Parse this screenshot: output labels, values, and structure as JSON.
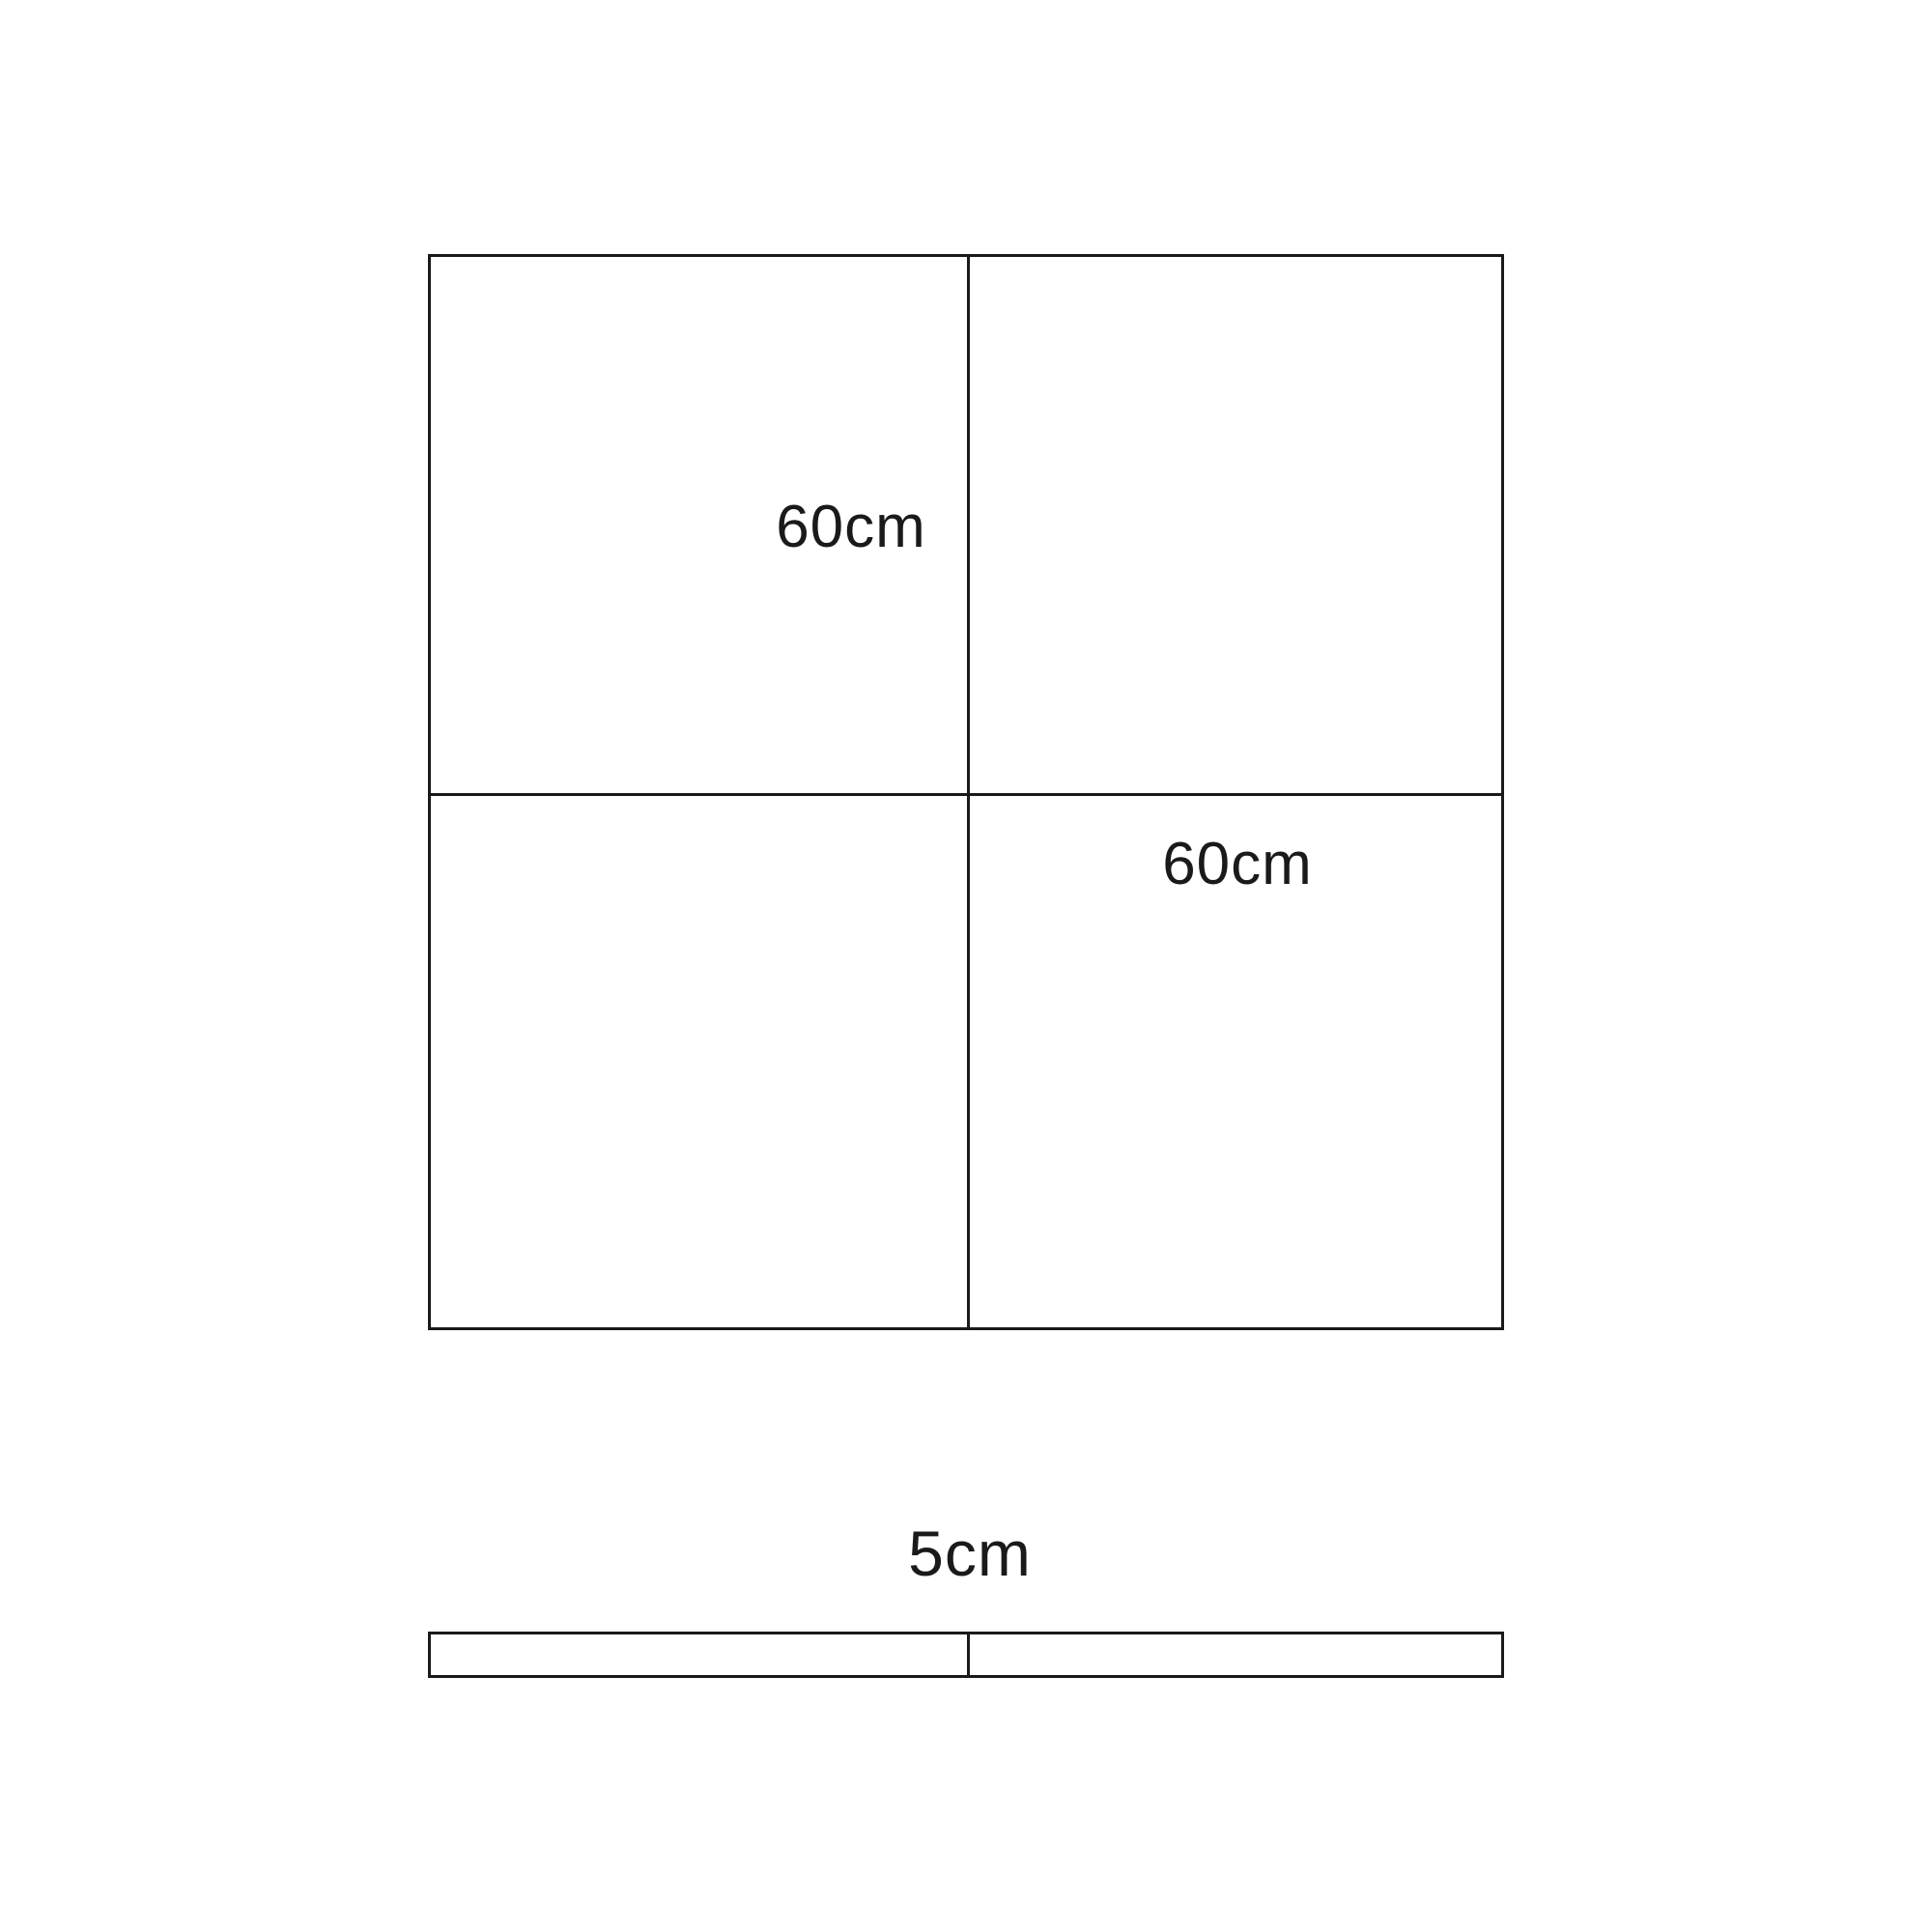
{
  "diagram": {
    "colors": {
      "background": "#ffffff",
      "line": "#1a1a1a",
      "text": "#1a1a1a"
    },
    "square": {
      "description": "large square divided into 4 equal quadrants",
      "quadrant_labels": {
        "top_left": "60cm",
        "bottom_right": "60cm"
      }
    },
    "strip": {
      "description": "thin horizontal bar divided into 2 equal segments",
      "label": "5cm"
    }
  }
}
